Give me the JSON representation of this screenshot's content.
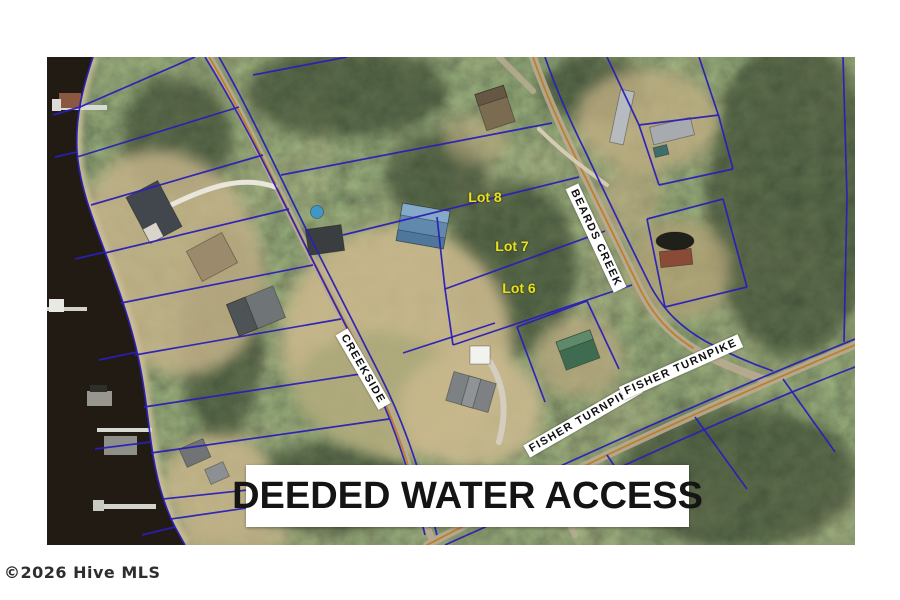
{
  "map": {
    "kind": "aerial-parcel-map-listing-photo",
    "banner": {
      "text": "DEEDED WATER ACCESS"
    },
    "watermark": {
      "text": "©2026 Hive MLS"
    },
    "lot_labels": [
      {
        "text": "Lot 8"
      },
      {
        "text": "Lot 7"
      },
      {
        "text": "Lot 6"
      }
    ],
    "street_labels": [
      {
        "text": "CREEKSIDE"
      },
      {
        "text": "BEARDS CREEK"
      },
      {
        "text": "FISHER TURNPIKE"
      },
      {
        "text": "FISHER TURNPIKE"
      }
    ],
    "colors": {
      "parcel_line": "#2a1fb8",
      "road_centerline": "#c07a1e",
      "road_surface": "#b8ab92",
      "water": "#221b14",
      "lot_label": "#e8e11f",
      "banner_bg": "#ffffff",
      "banner_text": "#141414",
      "street_label_bg": "#ffffff",
      "street_label_text": "#101010",
      "watermark_text": "#2e2e2e"
    }
  }
}
